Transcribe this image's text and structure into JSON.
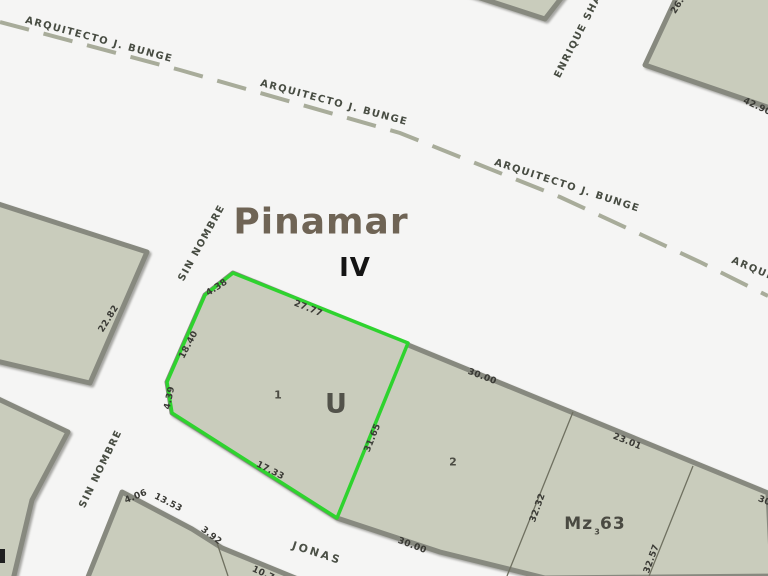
{
  "map_title": {
    "city": "Pinamar",
    "section": "IV"
  },
  "streets": {
    "arquitecto_bunge": "ARQUITECTO J. BUNGE",
    "enrique_shaw": "ENRIQUE SHAW",
    "sin_nombre": "SIN NOMBRE",
    "jonas": "JONAS"
  },
  "parcels": {
    "selected": {
      "id": "U",
      "number": "1"
    },
    "neighbor": {
      "number": "2"
    },
    "block": {
      "label": "Mz 63",
      "parcel_number": "3"
    }
  },
  "measurements": [
    "4.38",
    "27.77",
    "18.40",
    "4.39",
    "17.33",
    "31.65",
    "22.82",
    "4.06",
    "13.53",
    "3.92",
    "10.7",
    "30.00",
    "30.00",
    "23.01",
    "32.32",
    "32.57",
    "42.90",
    "26.",
    "30."
  ],
  "colors": {
    "highlight": "#2ed32e",
    "parcel_fill": "#c9ccbc",
    "parcel_border": "#87897f",
    "dashed_road": "#a8ac9a",
    "divider": "#6f7060"
  }
}
